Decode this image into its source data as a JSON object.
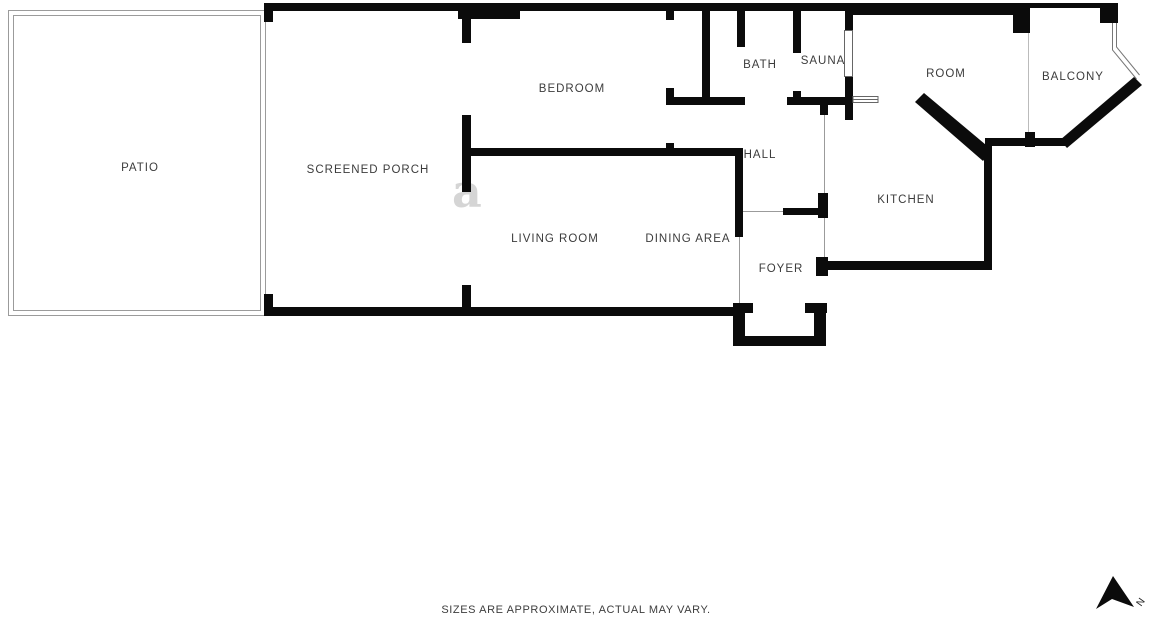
{
  "floorplan": {
    "rooms": {
      "patio": {
        "label": "PATIO"
      },
      "screened_porch": {
        "label": "SCREENED PORCH"
      },
      "bedroom": {
        "label": "BEDROOM"
      },
      "bath": {
        "label": "BATH"
      },
      "sauna": {
        "label": "SAUNA"
      },
      "room": {
        "label": "ROOM"
      },
      "balcony": {
        "label": "BALCONY"
      },
      "hall": {
        "label": "HALL"
      },
      "kitchen": {
        "label": "KITCHEN"
      },
      "living_room": {
        "label": "LIVING ROOM"
      },
      "dining_area": {
        "label": "DINING AREA"
      },
      "foyer": {
        "label": "FOYER"
      }
    },
    "colors": {
      "wall": "#0b0b0b",
      "thin_line": "#9b9b9b",
      "label": "#3c3c3c"
    },
    "watermark_glyph": "a"
  },
  "compass": {
    "label": "N"
  },
  "footer": {
    "disclaimer": "SIZES ARE APPROXIMATE, ACTUAL MAY VARY."
  }
}
